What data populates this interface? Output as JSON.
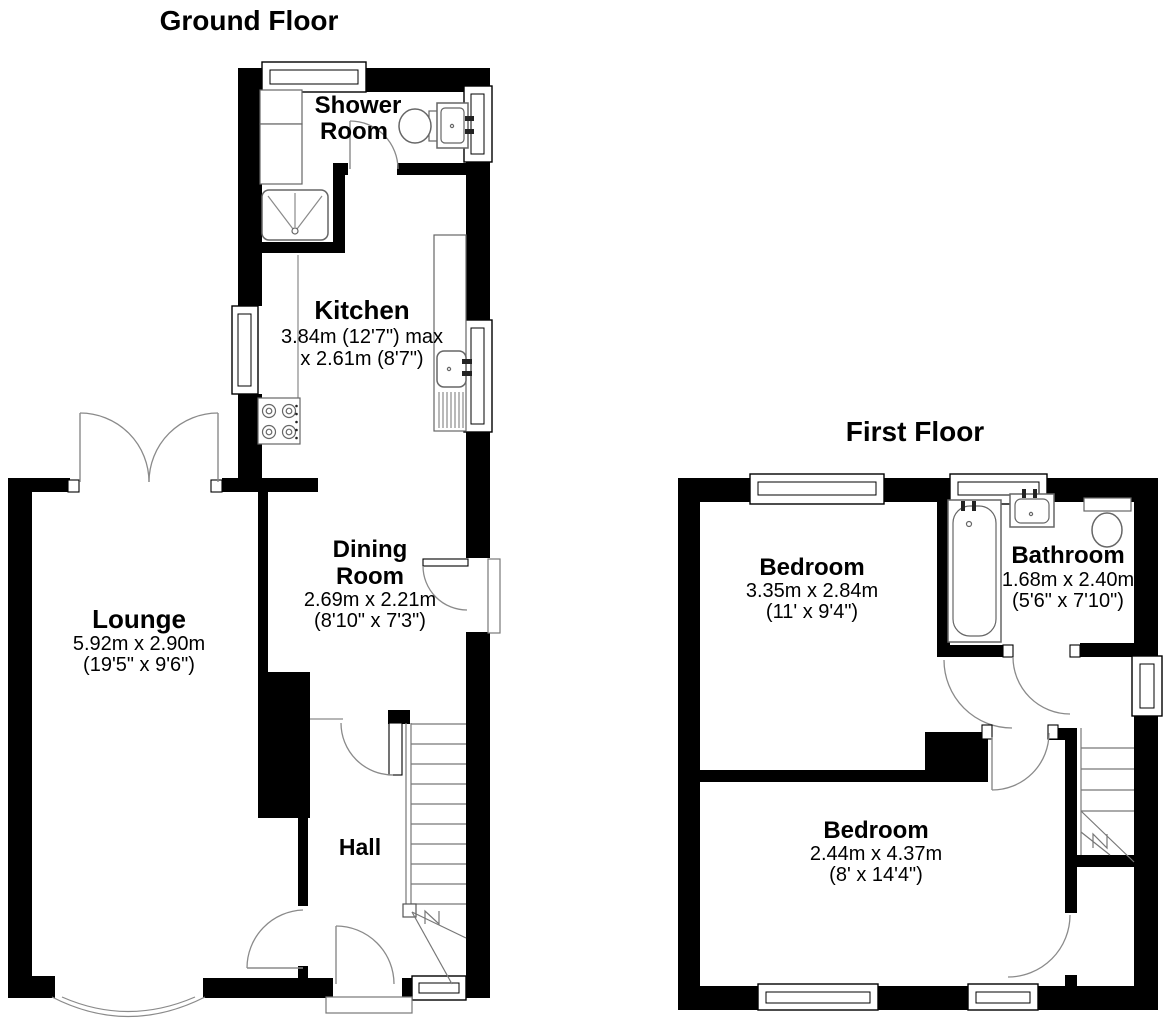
{
  "ground_floor": {
    "title": "Ground Floor",
    "rooms": {
      "shower_room": {
        "name_line1": "Shower",
        "name_line2": "Room"
      },
      "kitchen": {
        "name": "Kitchen",
        "dims_line1": "3.84m (12'7\") max",
        "dims_line2": "x 2.61m (8'7\")"
      },
      "dining_room": {
        "name_line1": "Dining",
        "name_line2": "Room",
        "dims_line1": "2.69m x 2.21m",
        "dims_line2": "(8'10\" x 7'3\")"
      },
      "lounge": {
        "name": "Lounge",
        "dims_line1": "5.92m x 2.90m",
        "dims_line2": "(19'5\" x 9'6\")"
      },
      "hall": {
        "name": "Hall"
      }
    },
    "fixtures": [
      "toilet",
      "basin",
      "shower-tray",
      "kitchen-sink",
      "hob",
      "staircase"
    ]
  },
  "first_floor": {
    "title": "First Floor",
    "rooms": {
      "bedroom_front": {
        "name": "Bedroom",
        "dims_line1": "3.35m x 2.84m",
        "dims_line2": "(11' x 9'4\")"
      },
      "bathroom": {
        "name": "Bathroom",
        "dims_line1": "1.68m x 2.40m",
        "dims_line2": "(5'6\" x 7'10\")"
      },
      "bedroom_back": {
        "name": "Bedroom",
        "dims_line1": "2.44m x 4.37m",
        "dims_line2": "(8' x 14'4\")"
      }
    },
    "fixtures": [
      "bath",
      "basin",
      "toilet",
      "staircase"
    ]
  },
  "colors": {
    "wall": "#000000",
    "background": "#ffffff",
    "fixture_line": "#666666",
    "text": "#000000"
  }
}
